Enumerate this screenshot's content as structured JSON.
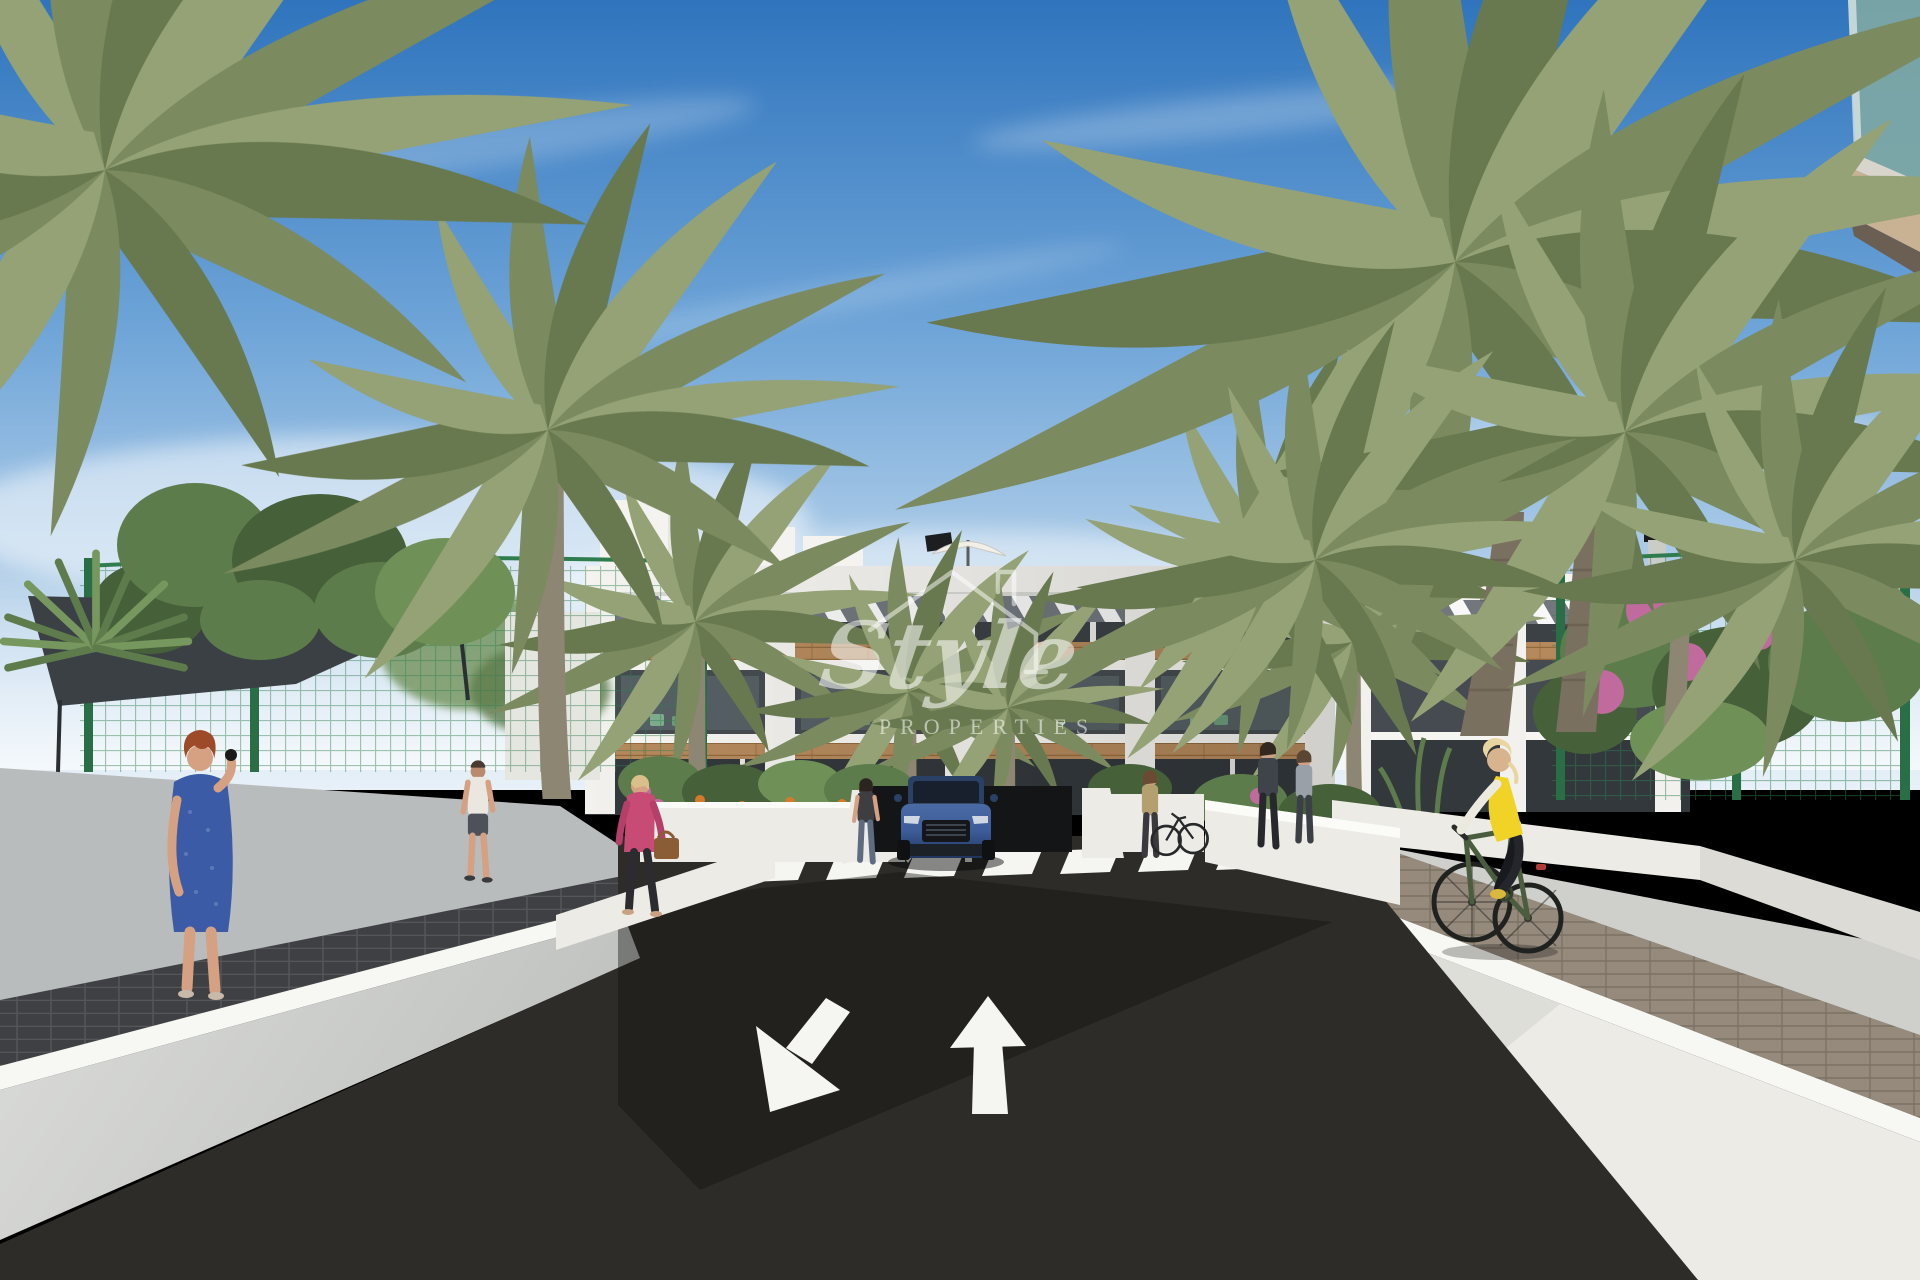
{
  "watermark": {
    "line1": "Style",
    "line2": "PROPERTIES"
  },
  "colors": {
    "sky_top": "#2f74bd",
    "sky_mid": "#6fa5d8",
    "sky_horizon": "#e8f1f8",
    "cloud_white": "#ffffff",
    "building_white": "#f4f3ef",
    "louvre_grey": "#71777d",
    "window_dark": "#3c4145",
    "wood_brown": "#b5895c",
    "terrace_dark": "#454b50",
    "ground_dark": "#33383c",
    "foliage_dark": "#46603a",
    "foliage_light": "#5d7c4b",
    "palm_green": "#7b8a5f",
    "palm_light": "#94a275",
    "trunk_grey": "#8d8672",
    "fence_green": "#2f7d4e",
    "flower_pink": "#c06a9e",
    "flower_orange": "#d57a2a",
    "asphalt_dark": "#2d2c29",
    "marking_white": "#f5f5f2",
    "walkway_grey": "#b9bcbd",
    "paver_dark": "#3f4144",
    "brick_tan": "#93887a",
    "pavement_light": "#cfd0cc",
    "wall_white": "#ecebe6",
    "wall_face": "#d6d7d4",
    "glass_teal": "#7fa8a4",
    "soffit_beige": "#c9b294",
    "car_blue": "#3c5d99",
    "car_blue_dark": "#20345c",
    "skin_tone": "#d5a182",
    "hair_red": "#9c4a28",
    "dress_blue": "#3b5ba6",
    "jacket_pink": "#c84b76",
    "vest_yellow": "#f0d326",
    "bike_green": "#4a5d3f",
    "watermark_white": "#ffffff"
  }
}
